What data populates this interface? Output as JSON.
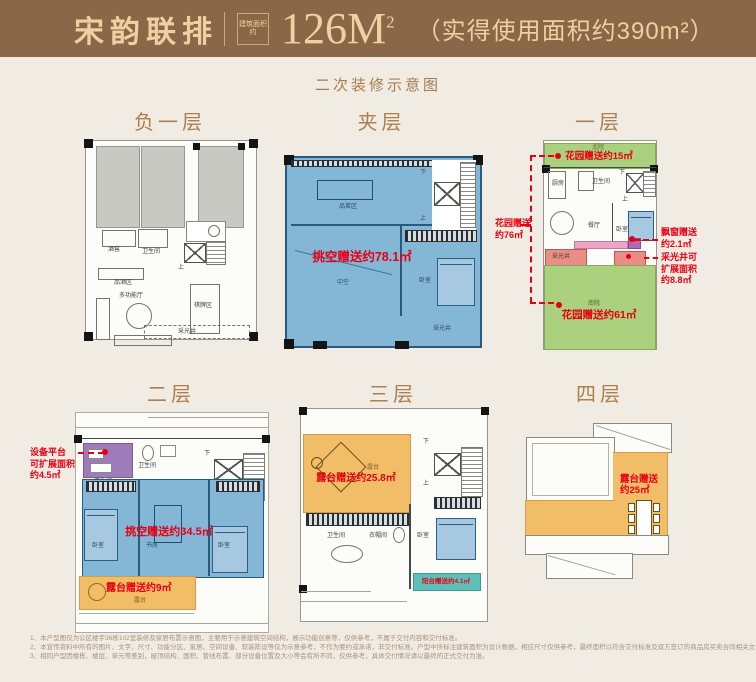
{
  "header": {
    "brand": "宋韵联排",
    "seal": "建筑面积约",
    "area_value": "126M",
    "area_sup": "2",
    "usable": "（实得使用面积约390m²）"
  },
  "subtitle": "二次装修示意图",
  "colors": {
    "header_bg": "#8a6847",
    "header_text": "#eed0a2",
    "accent_red": "#e60012",
    "void_blue": "#84b6d6",
    "garden_green": "#abd07e",
    "terrace_orange": "#f1bd67",
    "equip_purple": "#9e7cba",
    "lightwell_salmon": "#ea8e85",
    "balcony_teal": "#5fc0ba"
  },
  "floors": {
    "b1": {
      "title": "负一层",
      "wine_cellar": "酒窖",
      "bathroom": "卫生间",
      "tasting_area": "品酒区",
      "multi_hall": "多功能厅",
      "chess_area": "棋牌区",
      "light_well": "采光井",
      "up": "上"
    },
    "mezzanine": {
      "title": "夹层",
      "tea_area": "品茗区",
      "void": "中空",
      "bedroom": "卧室",
      "light_well": "采光井",
      "down": "下",
      "up": "上",
      "gift": "挑空赠送约78.1㎡"
    },
    "f1": {
      "title": "一层",
      "north_yard": "北院",
      "garden_north_gift": "花园赠送约15㎡",
      "kitchen": "厨房",
      "bathroom": "卫生间",
      "dining": "餐厅",
      "bedroom": "卧室",
      "down": "下",
      "up": "上",
      "light_well": "采光井",
      "south_yard": "南院",
      "garden_south_gift": "花园赠送约61㎡",
      "garden_left_gift_1": "花园赠送",
      "garden_left_gift_2": "约76㎡",
      "bay_gift_1": "飘窗赠送",
      "bay_gift_2": "约2.1㎡",
      "lw_gift_1": "采光井可",
      "lw_gift_2": "扩展面积",
      "lw_gift_3": "约8.8㎡"
    },
    "f2": {
      "title": "二层",
      "equip_1": "设备平台",
      "equip_2": "可扩展面积",
      "equip_3": "约4.5㎡",
      "bath1": "卫生间",
      "bath2": "卫生间",
      "bed1": "卧室",
      "study": "书房",
      "bed2": "卧室",
      "void_gift": "挑空赠送约34.5㎡",
      "terrace_gift": "露台赠送约9㎡",
      "terrace": "露台",
      "down": "下",
      "up": "上"
    },
    "f3": {
      "title": "三层",
      "terrace": "露台",
      "terrace_gift": "露台赠送约25.8㎡",
      "bath": "卫生间",
      "closet": "衣帽间",
      "bedroom": "卧室",
      "balcony_gift": "阳台赠送约4.1㎡",
      "down": "下",
      "up": "上"
    },
    "f4": {
      "title": "四层",
      "terrace_gift_1": "露台赠送",
      "terrace_gift_2": "约25㎡"
    }
  },
  "footnotes": {
    "line1": "1、本户型图仅为公区楼宇36栋102室装修及家居布置示意图，主要用于示意建筑空间结构，展示功能创意等，仅供参考，不属于交付内容和交付标准。",
    "line2": "2、本宣传资料中所有的图片、文字、尺寸、功能分区、家居、空间设备、软装陈设等仅为示意参考，不作为要约或承诺，非交付标准。户型中所标注建筑面积为设计数据，相应尺寸仅供参考，最终面积以符合交付标准及双方签订的商品房买卖合同相关文件为准。",
    "line3": "3、相同户型因楼栋、楼层、单元等差别，屋顶结构、面积、管线布置、部分设备位置及大小等会有所不同，仅供参考，具体交付情况请以最终的正式交付为准。"
  }
}
